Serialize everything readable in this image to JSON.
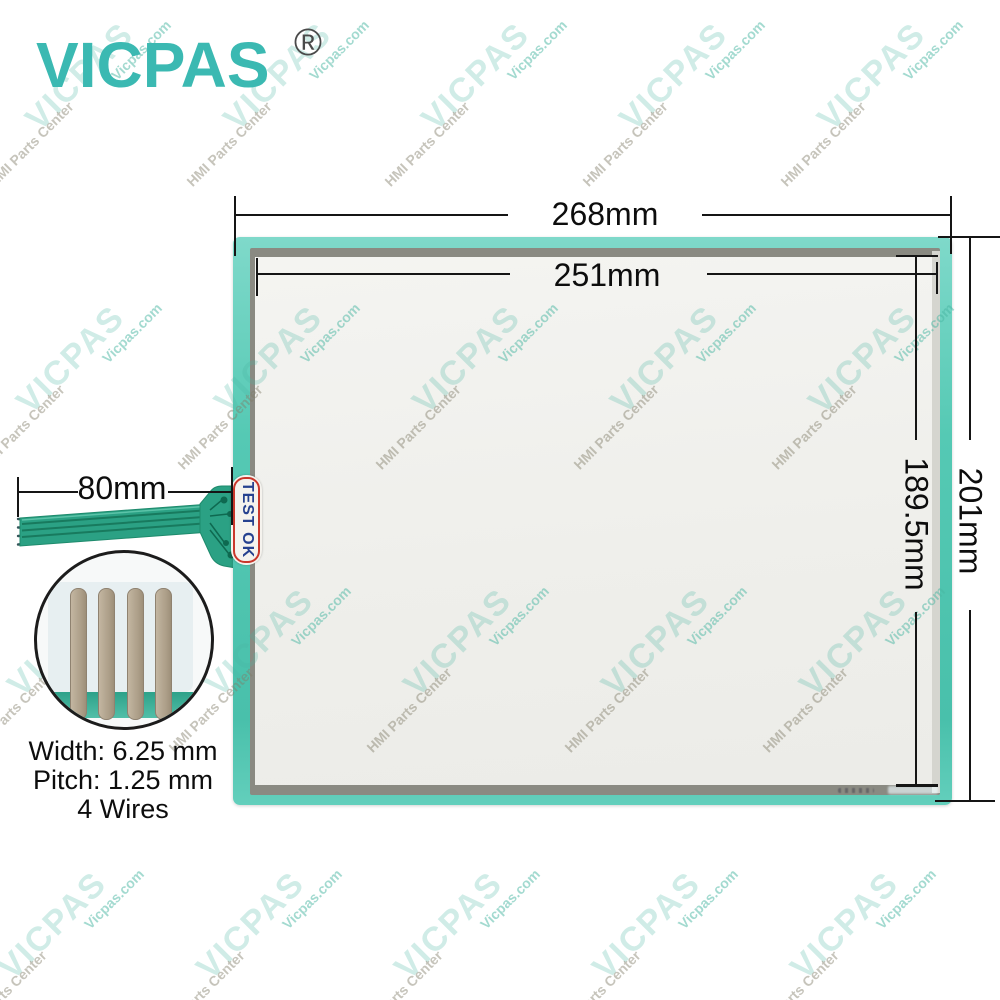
{
  "brand": {
    "logo_text": "VICPAS",
    "registered_mark": "®"
  },
  "watermark": {
    "primary": "VICPAS",
    "secondary": "HMI Parts Center",
    "tertiary": "Vicpas.com"
  },
  "dimensions": {
    "outer_width": "268mm",
    "active_width": "251mm",
    "active_height": "189.5mm",
    "outer_height": "201mm",
    "tail_length": "80mm"
  },
  "tail": {
    "test_label": "TEST OK",
    "specs": {
      "width": "Width: 6.25 mm",
      "pitch": "Pitch: 1.25 mm",
      "wires": "4 Wires"
    }
  },
  "colors": {
    "brand_teal": "#3bb9b2",
    "panel_frame_teal": "#55c9b4",
    "panel_inner_gray": "#8a8a82",
    "screen_white": "#f2f2ef",
    "cable_green": "#2ba184",
    "test_label_red": "#c9372b",
    "test_label_blue": "#26418f",
    "wire_tan": "#b7aa95",
    "dimension_black": "#151515"
  }
}
